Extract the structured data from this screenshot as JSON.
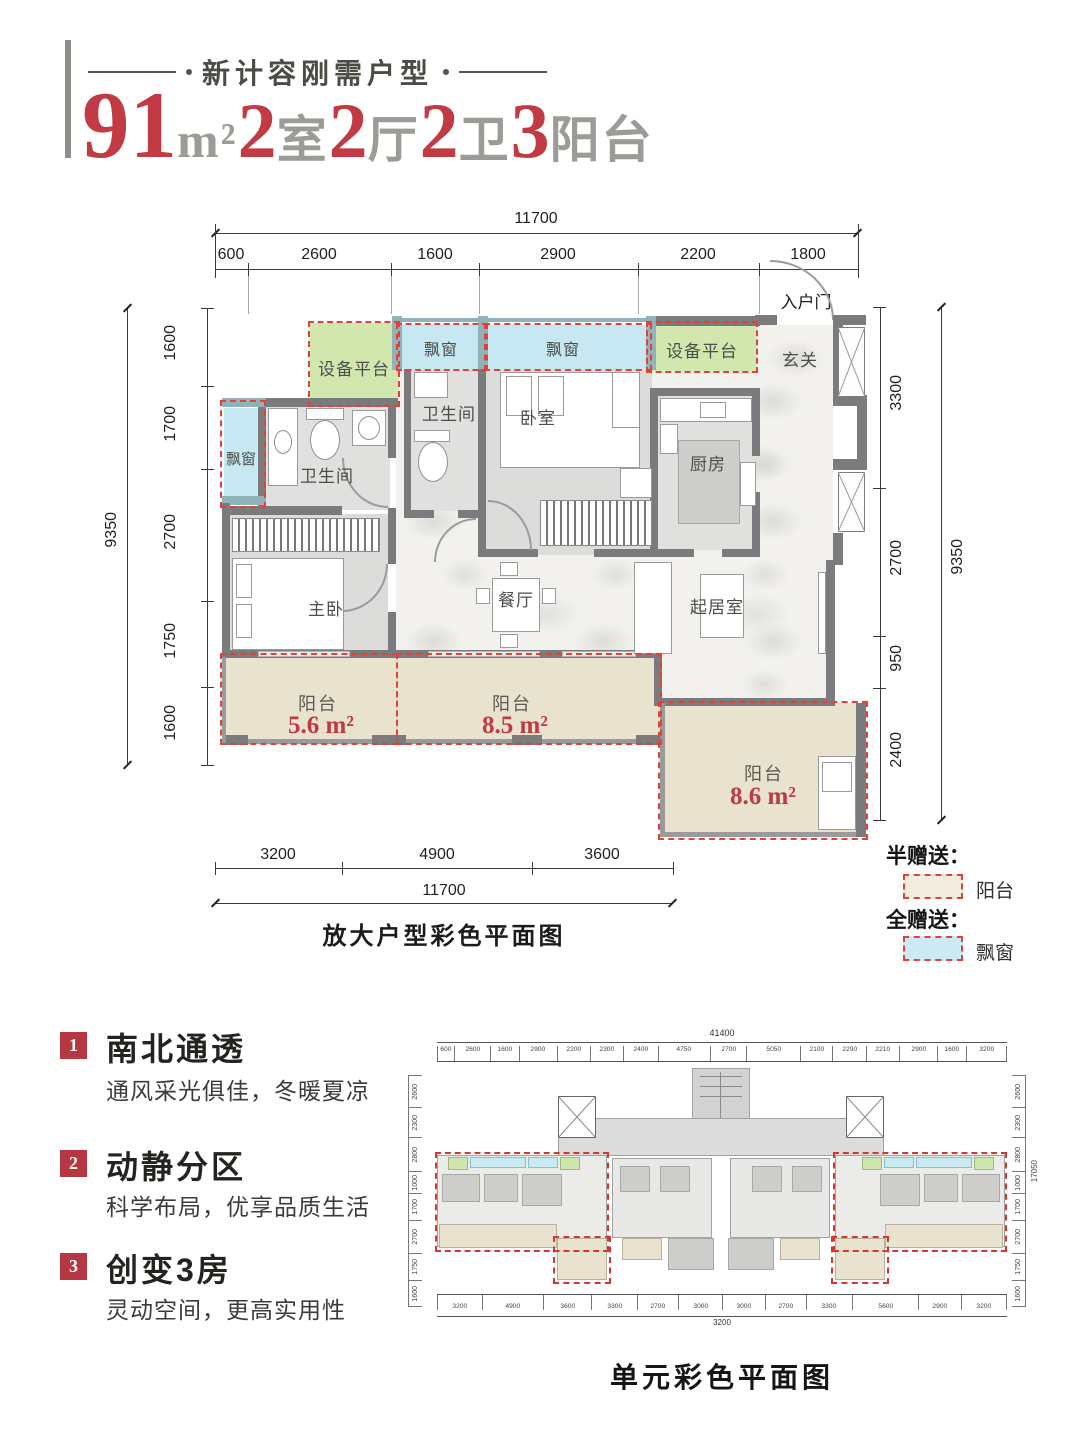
{
  "header": {
    "tagline": "新计容刚需户型",
    "title": {
      "area_num": "91",
      "area_unit": "m²",
      "n1": "2",
      "u1": "室",
      "n2": "2",
      "u2": "厅",
      "n3": "2",
      "u3": "卫",
      "n4": "3",
      "u4": "阳台"
    }
  },
  "plan": {
    "caption": "放大户型彩色平面图",
    "entry_door": "入户门",
    "dims": {
      "top_total": "11700",
      "top_segs": [
        "600",
        "2600",
        "1600",
        "2900",
        "2200",
        "1800"
      ],
      "left_total": "9350",
      "left_segs": [
        "1600",
        "1700",
        "2700",
        "1750",
        "1600"
      ],
      "right_total": "9350",
      "right_segs": [
        "3300",
        "2700",
        "950",
        "2400"
      ],
      "bottom_total": "11700",
      "bottom_segs": [
        "3200",
        "4900",
        "3600"
      ]
    },
    "rooms": {
      "equip_left": "设备平台",
      "equip_right": "设备平台",
      "bay_top_1": "飘窗",
      "bay_top_2": "飘窗",
      "bay_left": "飘窗",
      "bath_master": "卫生间",
      "bath_second": "卫生间",
      "bedroom": "卧室",
      "kitchen": "厨房",
      "foyer": "玄关",
      "dining": "餐厅",
      "living": "起居室",
      "master_bedroom": "主卧"
    },
    "balconies": {
      "b1_label": "阳台",
      "b1_area": "5.6 m²",
      "b2_label": "阳台",
      "b2_area": "8.5 m²",
      "b3_label": "阳台",
      "b3_area": "8.6 m²"
    }
  },
  "legend": {
    "half_title": "半赠送：",
    "half_item": "阳台",
    "full_title": "全赠送：",
    "full_item": "飘窗"
  },
  "features": [
    {
      "num": "1",
      "title": "南北通透",
      "desc": "通风采光俱佳，冬暖夏凉"
    },
    {
      "num": "2",
      "title": "动静分区",
      "desc": "科学布局，优享品质生活"
    },
    {
      "num": "3",
      "title": "创变3房",
      "desc": "灵动空间，更高实用性"
    }
  ],
  "unit_plan": {
    "caption": "单元彩色平面图",
    "top_total": "41400",
    "top_segs": [
      "600",
      "2600",
      "1600",
      "2900",
      "2200",
      "2300",
      "2400",
      "4750",
      "2700",
      "5050",
      "2100",
      "2290",
      "2210",
      "2900",
      "1600",
      "3200"
    ],
    "bottom_segs": [
      "3200",
      "4900",
      "3600",
      "3300",
      "2700",
      "3000",
      "3000",
      "2700",
      "3300",
      "5600",
      "2900",
      "3200"
    ],
    "bottom_sub": "3200",
    "side_total": "17050",
    "side_segs": [
      "2600",
      "2300",
      "2800",
      "1000",
      "1700",
      "2700",
      "1750",
      "1600"
    ]
  },
  "colors": {
    "accent_red": "#bf3a42",
    "dash_red": "#e04336",
    "bay_blue": "#c7e8f2",
    "equip_green": "#d2e7ad",
    "balcony_beige": "#e9e2cf",
    "wall_gray": "#7b7b7e"
  }
}
